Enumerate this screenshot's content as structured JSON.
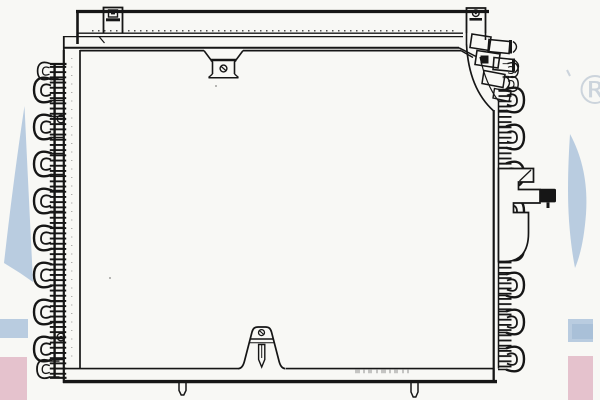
{
  "registered_mark": "®",
  "colors": {
    "background": "#f8f8f5",
    "line": "#161616",
    "watermark_blue": "#b9cce0",
    "watermark_blue_deep": "#a9c0d8",
    "watermark_pink": "#e5c2cd",
    "watermark_gray": "#ccd4dc",
    "stamp_gray": "#8f8f8f"
  },
  "figure": {
    "kind": "monochrome technical line drawing",
    "subject": "automotive air-conditioning condenser, front view",
    "parts": [
      "top-mounting-rail",
      "mounting-tab-top-left",
      "mounting-tab-top-right",
      "screw-bracket-top-center",
      "side-plate-left",
      "side-plate-right",
      "serpentine-fin-coil-left",
      "serpentine-fin-coil-right",
      "refrigerant-fitting-cluster-top-right",
      "side-bracket-with-bolt-right",
      "bottom-rail",
      "screw-bracket-bottom-center",
      "mounting-pin-bottom-left",
      "mounting-pin-bottom-right"
    ]
  },
  "watermark": {
    "fragments": [
      "letter-fragment-left-edge",
      "letter-fragment-right-edge",
      "blue-bar-left-edge",
      "blue-bar-right-edge",
      "pink-bar-left-edge",
      "pink-bar-right-edge",
      "registered-symbol"
    ]
  }
}
